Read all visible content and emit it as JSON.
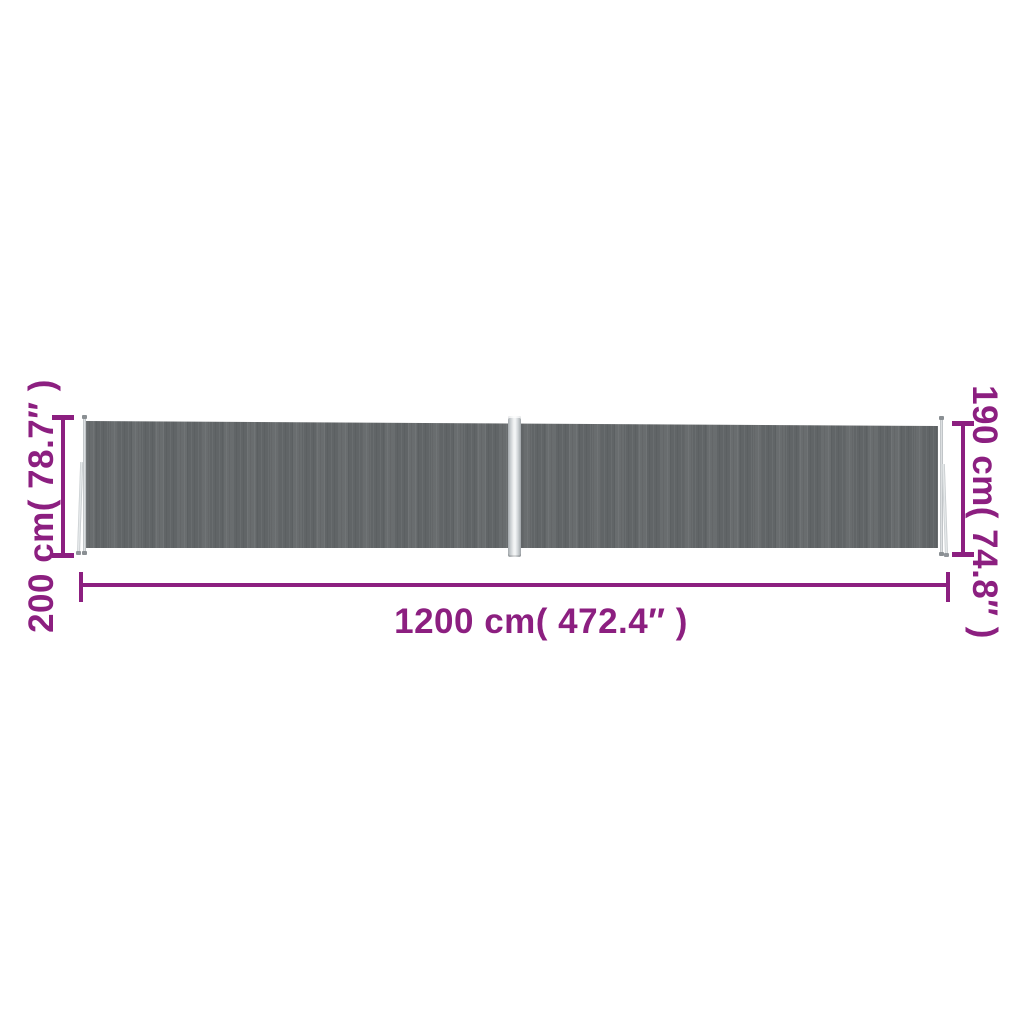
{
  "colors": {
    "accent": "#8c1f80",
    "fabric": "#64686a",
    "metal": "#c9ced1",
    "background": "#ffffff"
  },
  "dimensions": {
    "height_left": "200 cm( 78.7″ )",
    "height_right": "190 cm( 74.8″ )",
    "width_bottom": "1200 cm( 472.4″ )"
  }
}
